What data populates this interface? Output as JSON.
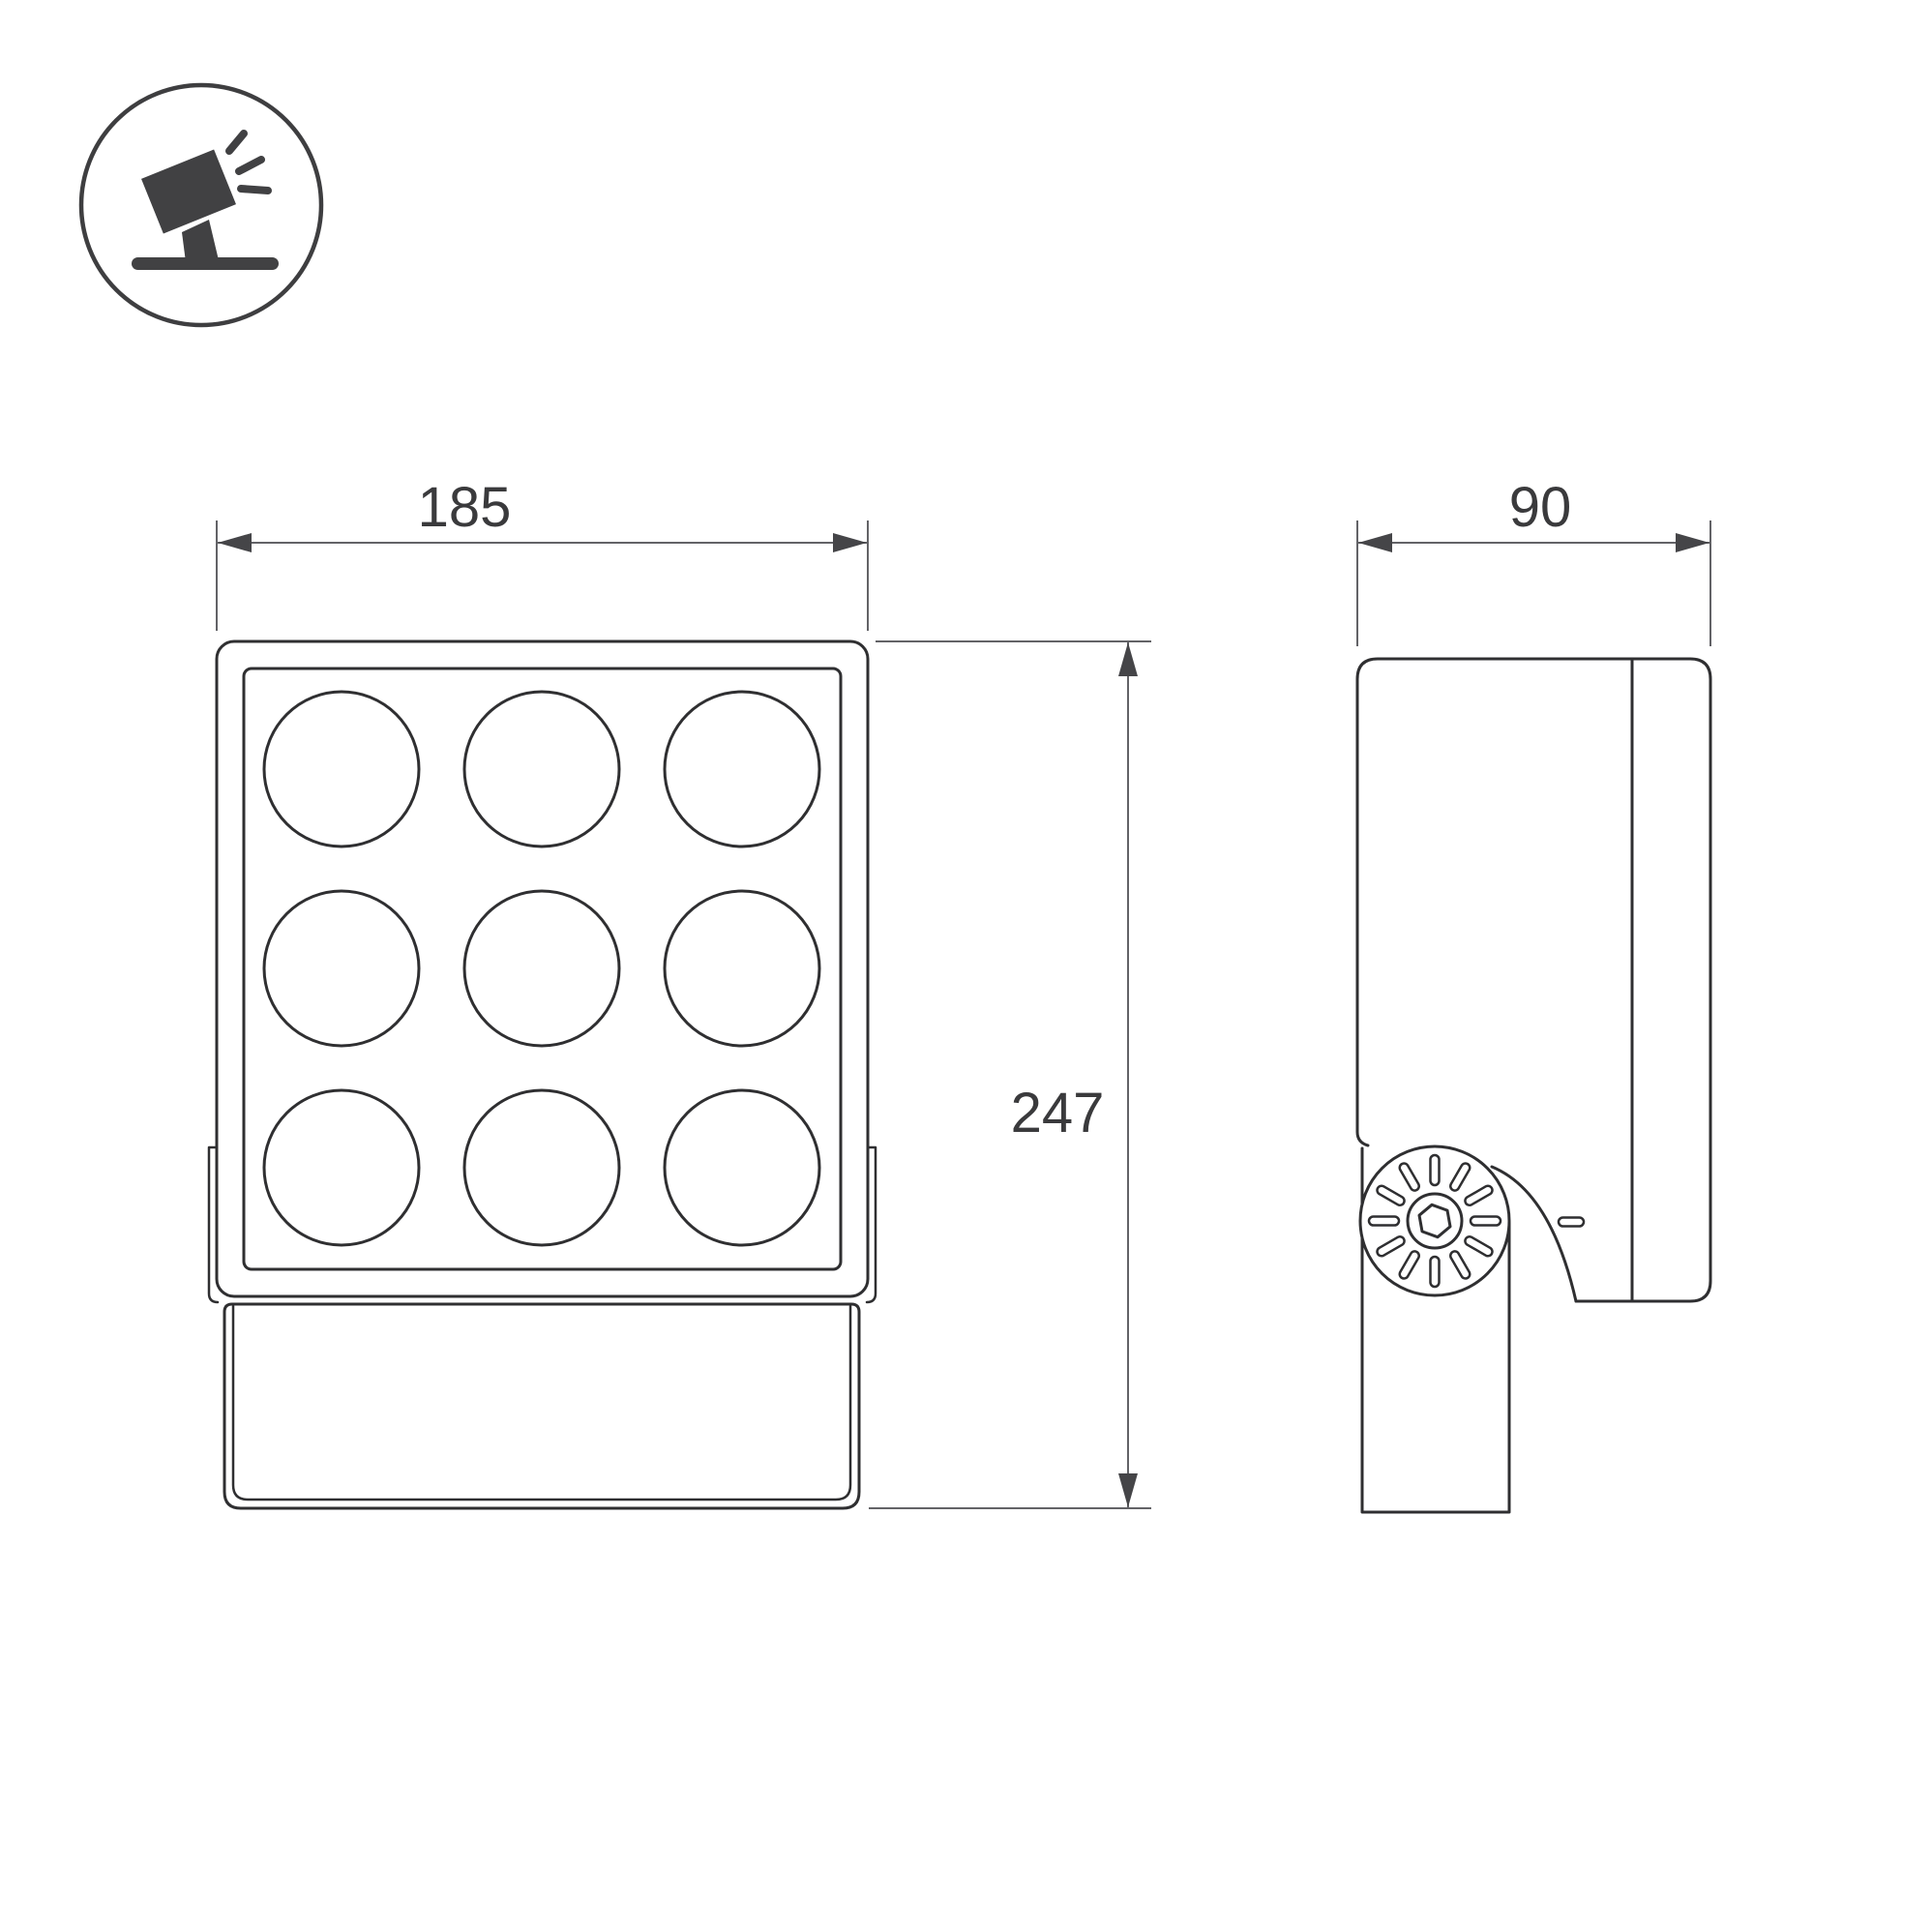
{
  "drawing": {
    "type": "technical-dimension-drawing",
    "product": "led-floodlight-9-lens",
    "views": {
      "front": {
        "name": "front-view"
      },
      "side": {
        "name": "side-view"
      }
    },
    "dimensions": {
      "width": "185",
      "height": "247",
      "depth": "90"
    },
    "icon": {
      "name": "tilted-floodlight-on-stand-icon"
    },
    "colors": {
      "background": "#ffffff",
      "outline": "#2f2f31",
      "dimension_lines": "#636367",
      "dimension_text": "#3a3a3c",
      "icon_fill": "#414143"
    }
  }
}
